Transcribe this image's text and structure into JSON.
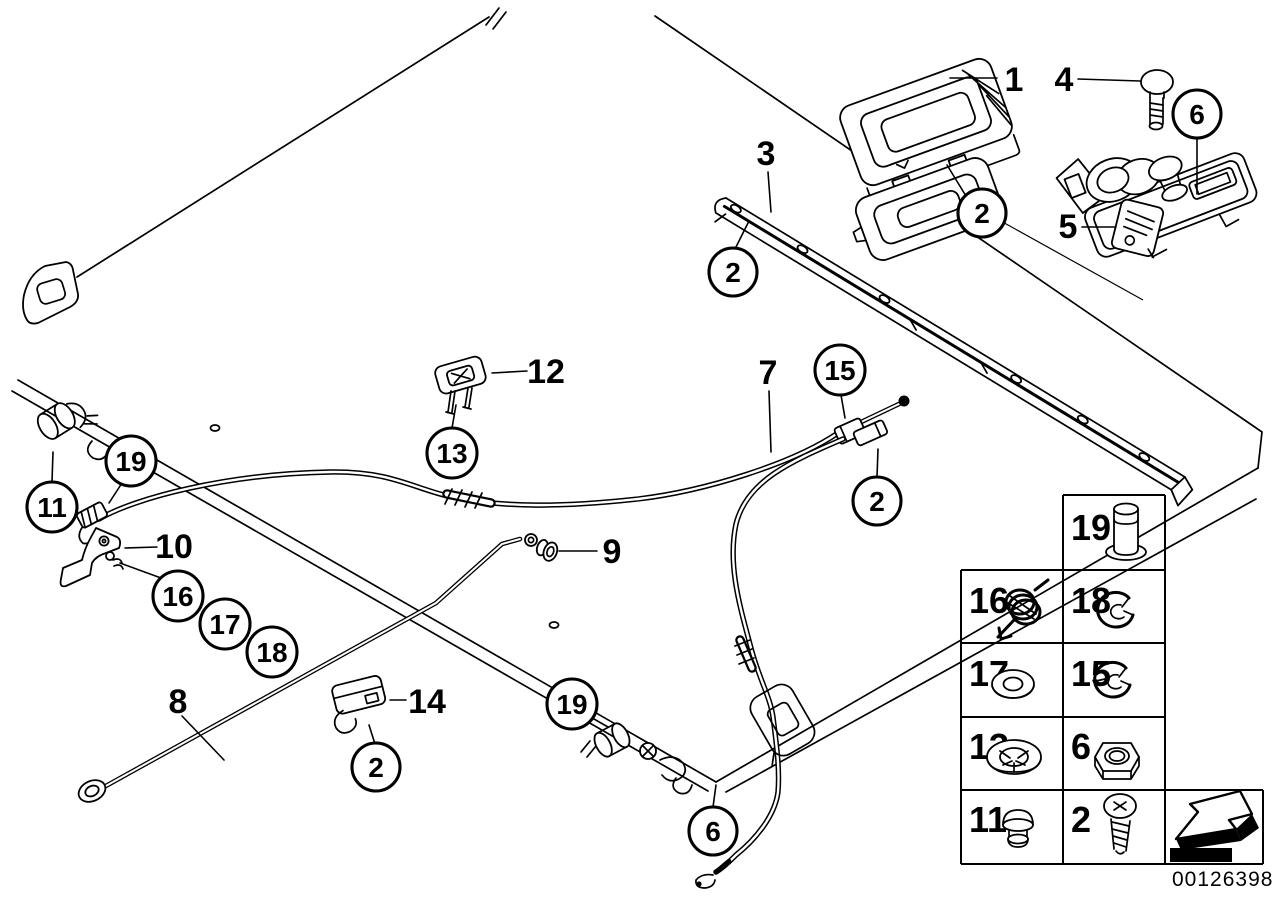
{
  "figure": {
    "drawing_number": "00126398",
    "line_color": "#000000",
    "background_color": "#ffffff"
  },
  "callouts": [
    {
      "label": "1",
      "style": "plain"
    },
    {
      "label": "4",
      "style": "plain"
    },
    {
      "label": "6",
      "style": "circled"
    },
    {
      "label": "3",
      "style": "plain"
    },
    {
      "label": "2",
      "style": "circled"
    },
    {
      "label": "5",
      "style": "plain"
    },
    {
      "label": "2",
      "style": "circled"
    },
    {
      "label": "12",
      "style": "plain"
    },
    {
      "label": "13",
      "style": "circled"
    },
    {
      "label": "7",
      "style": "plain"
    },
    {
      "label": "15",
      "style": "circled"
    },
    {
      "label": "2",
      "style": "circled"
    },
    {
      "label": "19",
      "style": "circled"
    },
    {
      "label": "11",
      "style": "circled"
    },
    {
      "label": "10",
      "style": "plain"
    },
    {
      "label": "16",
      "style": "circled"
    },
    {
      "label": "17",
      "style": "circled"
    },
    {
      "label": "18",
      "style": "circled"
    },
    {
      "label": "9",
      "style": "plain"
    },
    {
      "label": "8",
      "style": "plain"
    },
    {
      "label": "14",
      "style": "plain"
    },
    {
      "label": "2",
      "style": "circled"
    },
    {
      "label": "19",
      "style": "circled"
    },
    {
      "label": "6",
      "style": "circled"
    }
  ],
  "legend": {
    "cells": [
      {
        "label": "19",
        "icon": "clevis-pin-icon"
      },
      {
        "label": "16",
        "icon": "spring-icon"
      },
      {
        "label": "18",
        "icon": "e-clip-icon"
      },
      {
        "label": "17",
        "icon": "washer-icon"
      },
      {
        "label": "15",
        "icon": "e-clip-icon"
      },
      {
        "label": "13",
        "icon": "lock-washer-icon"
      },
      {
        "label": "6",
        "icon": "hex-nut-icon"
      },
      {
        "label": "11",
        "icon": "plug-icon"
      },
      {
        "label": "2",
        "icon": "screw-icon"
      }
    ]
  }
}
